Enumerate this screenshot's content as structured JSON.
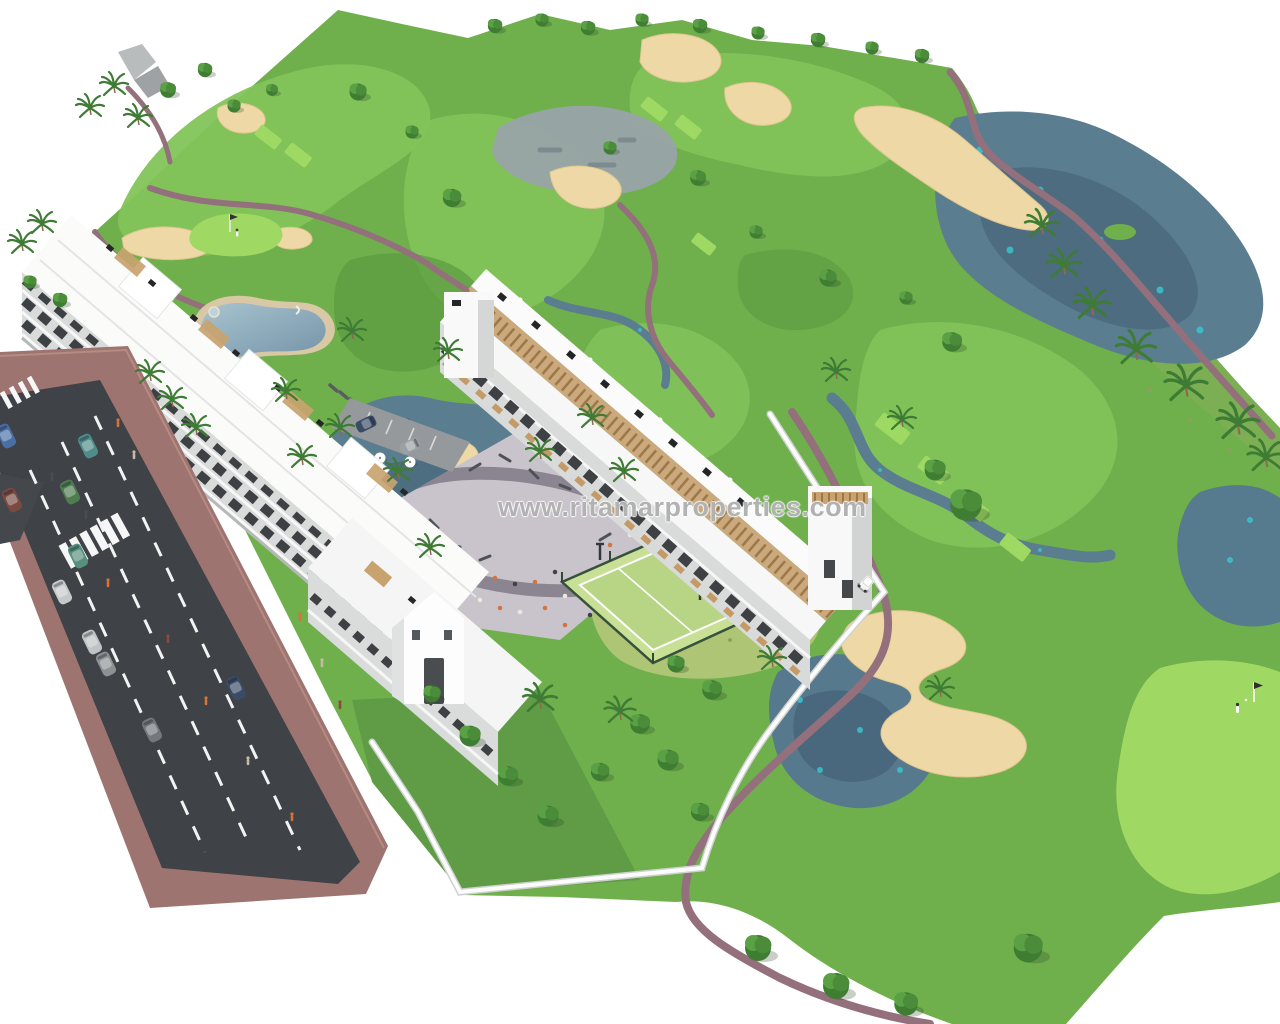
{
  "watermark": {
    "text": "www.ritamarproperties.com"
  },
  "scene": {
    "description": "Aerial 3D architectural rendering of a white apartment complex beside a golf course with lakes, sand bunkers, pool, playground plaza, padel court and an access road with cars",
    "elements": {
      "golf_course": "golf course with fairways, greens and tee boxes",
      "lakes": "irregular gray-blue lakes with turquoise highlights",
      "sand_bunkers": "tan sand bunkers and waste areas",
      "cart_paths": "mauve winding cart paths",
      "building_a": "long white 4-storey apartment block along the road",
      "building_b": "terraced white apartment block with wooden pergolas",
      "pool": "lagoon-style pool with sun loungers and white parasols",
      "plaza": "paved playground plaza with people",
      "padel_court": "fenced light-green padel court",
      "road": "asphalt avenue with dashed lanes, zebra crossings, cars and pedestrians",
      "golf_green_right": "bright putting green with flag and golfer",
      "golf_cart": "white golf cart on path"
    }
  },
  "palette": {
    "sky": "#ffffff",
    "fairway": "#6fb04c",
    "fairway_light": "#83c45a",
    "green_bright": "#9fd964",
    "water": "#5a7d90",
    "water_accent": "#38c4cc",
    "sand": "#eed8a6",
    "cart_path": "#93707b",
    "road_asphalt": "#3f4246",
    "sidewalk": "#9d7470",
    "building_white": "#f6f7f6",
    "wood": "#c9a36f",
    "padel_court": "#c8df96",
    "plaza": "#cac5cd"
  }
}
